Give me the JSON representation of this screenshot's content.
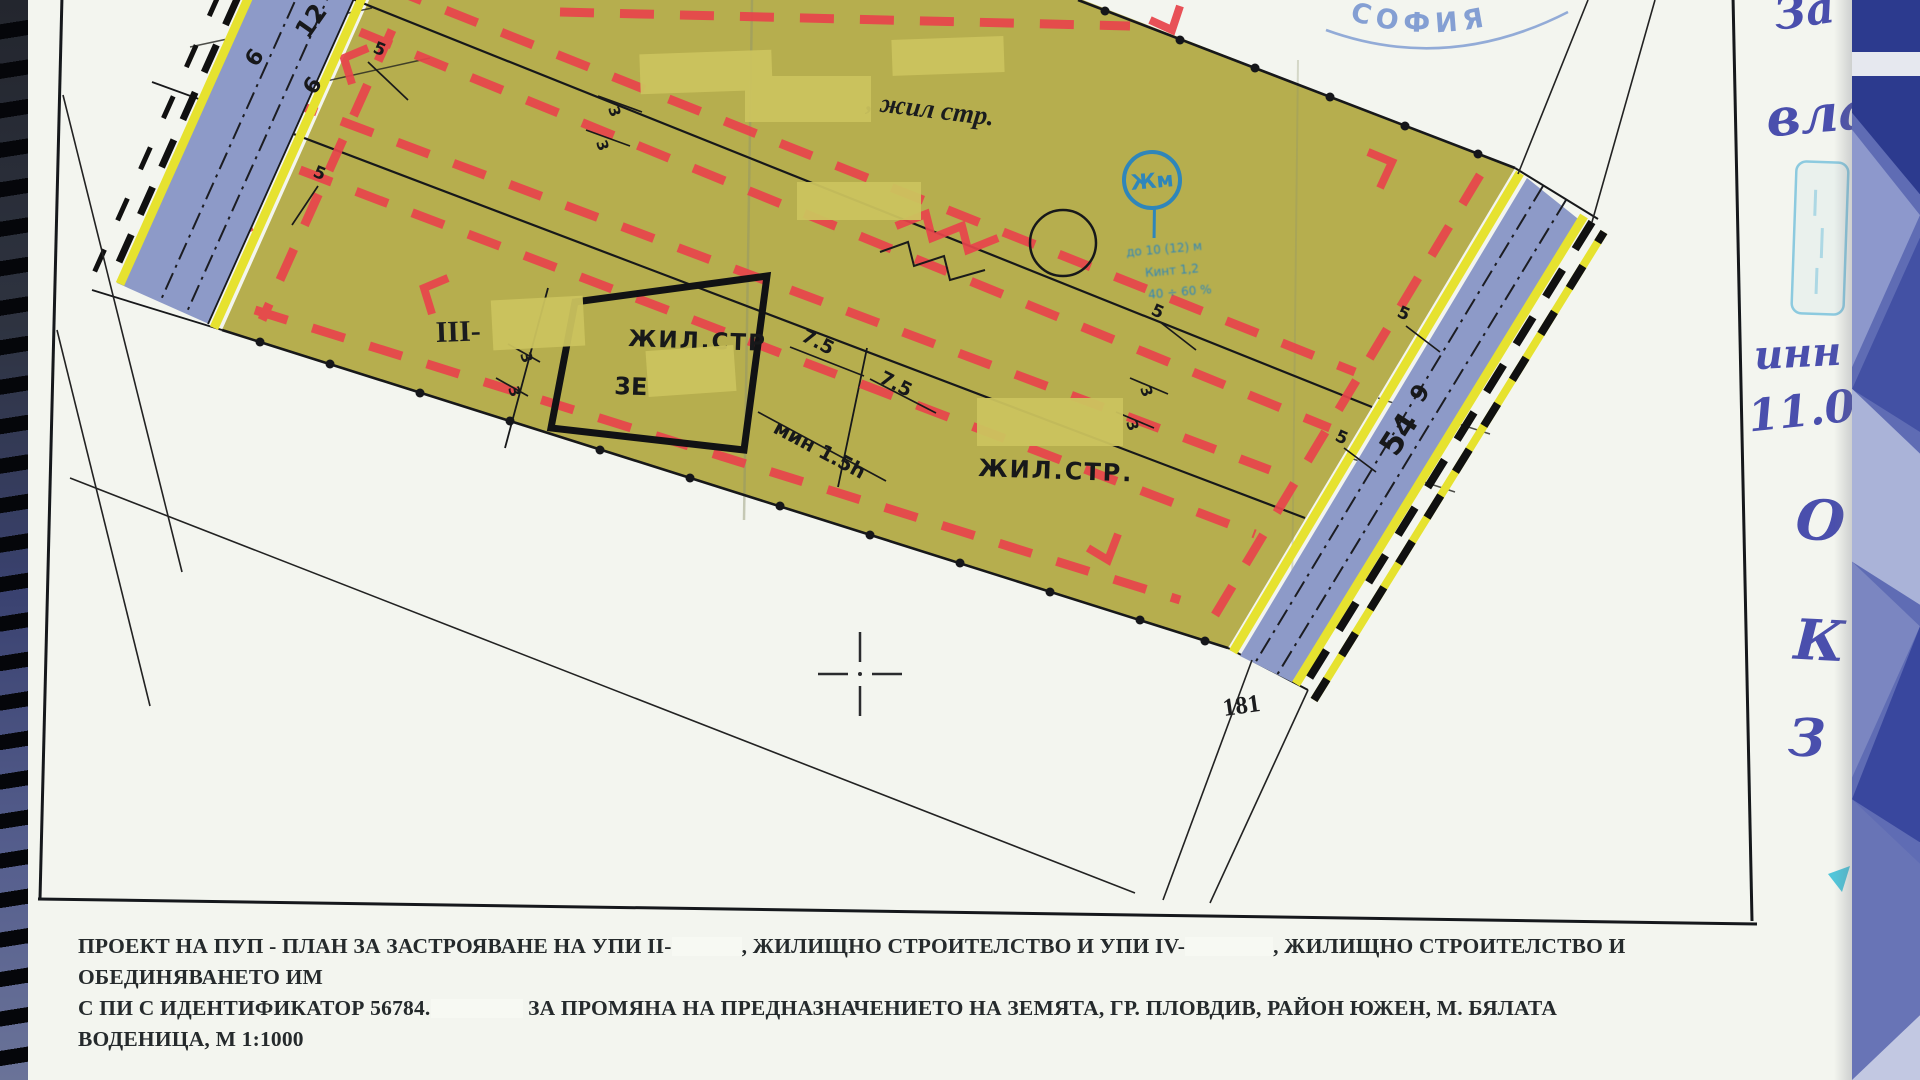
{
  "colors": {
    "zone_fill": "#b6ae4e",
    "road_fill": "#8d9ac8",
    "edge_band_yellow": "#e6e22f",
    "building_line_red": "#e8444b",
    "handwriting_ink": "#3c42a8",
    "zone_stamp_blue": "#2f86ba",
    "sofia_stamp_blue": "#7191cf",
    "redaction_patch": "#ccc35e"
  },
  "caption": {
    "line1_a": "ПРОЕКТ НА ПУП - ПЛАН ЗА ЗАСТРОЯВАНЕ НА УПИ II-",
    "line1_b": ", ЖИЛИЩНО СТРОИТЕЛСТВО И УПИ IV-",
    "line1_c": ", ЖИЛИЩНО СТРОИТЕЛСТВО И ОБЕДИНЯВАНЕТО ИМ",
    "line2_a": "С ПИ С ИДЕНТИФИКАТОР 56784.",
    "line2_b": "ЗА ПРОМЯНА НА ПРЕДНАЗНАЧЕНИЕТО НА ЗЕМЯТА, ГР. ПЛОВДИВ, РАЙОН ЮЖЕН, М. БЯЛАТА ВОДЕНИЦА, М 1:1000"
  },
  "plan_labels": {
    "parcel_iii": "III-",
    "top_note": ", жил стр.",
    "building_name": "ЖИЛ.СТР",
    "building_floors": "3Е",
    "lower_name": "ЖИЛ.СТР.",
    "plot_number": "181"
  },
  "dimensions": {
    "seven_five": "7.5",
    "min_h": "мин 1.5h",
    "five": "5",
    "three": "3"
  },
  "road_left": {
    "w12": "12",
    "w6a": "6",
    "w6b": "6"
  },
  "road_right": {
    "n9": "9",
    "n54": "54",
    "n5": "5"
  },
  "stamps": {
    "sofia": "СОФИЯ",
    "zone": {
      "symbol": "Жм",
      "line1": "до 10 (12) м",
      "line2": "Кинт 1,2",
      "line3": "40 ÷ 60 %"
    }
  },
  "handwriting": {
    "h1": "За",
    "h2": "вла",
    "h3": "инн",
    "h4": "11.0",
    "h5": "О",
    "h6": "К",
    "h7": "З"
  }
}
